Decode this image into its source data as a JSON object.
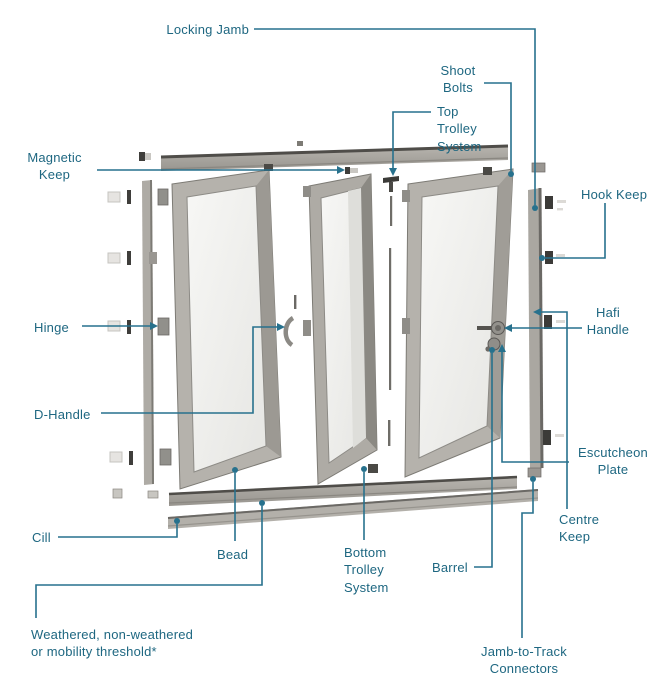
{
  "diagram": {
    "type": "exploded-parts-diagram",
    "subject": "bi-fold door system",
    "labels": {
      "locking_jamb": "Locking Jamb",
      "shoot_bolts": "Shoot\nBolts",
      "top_trolley": "Top\nTrolley\nSystem",
      "magnetic_keep": "Magnetic\nKeep",
      "hook_keep": "Hook Keep",
      "hinge": "Hinge",
      "hafi_handle": "Hafi\nHandle",
      "d_handle": "D-Handle",
      "escutcheon_plate": "Escutcheon\nPlate",
      "centre_keep": "Centre\nKeep",
      "cill": "Cill",
      "bead": "Bead",
      "bottom_trolley": "Bottom\nTrolley\nSystem",
      "barrel": "Barrel",
      "threshold": "Weathered, non-weathered\nor mobility threshold*",
      "jamb_to_track": "Jamb-to-Track\nConnectors"
    },
    "colors": {
      "label_text": "#1e6781",
      "leader_line": "#27718d",
      "frame_aluminium": "#b5b2ac",
      "frame_shadow": "#8b8983",
      "glass": "#f2f2ef",
      "hardware_dark": "#3c3b38",
      "background": "#ffffff"
    }
  }
}
